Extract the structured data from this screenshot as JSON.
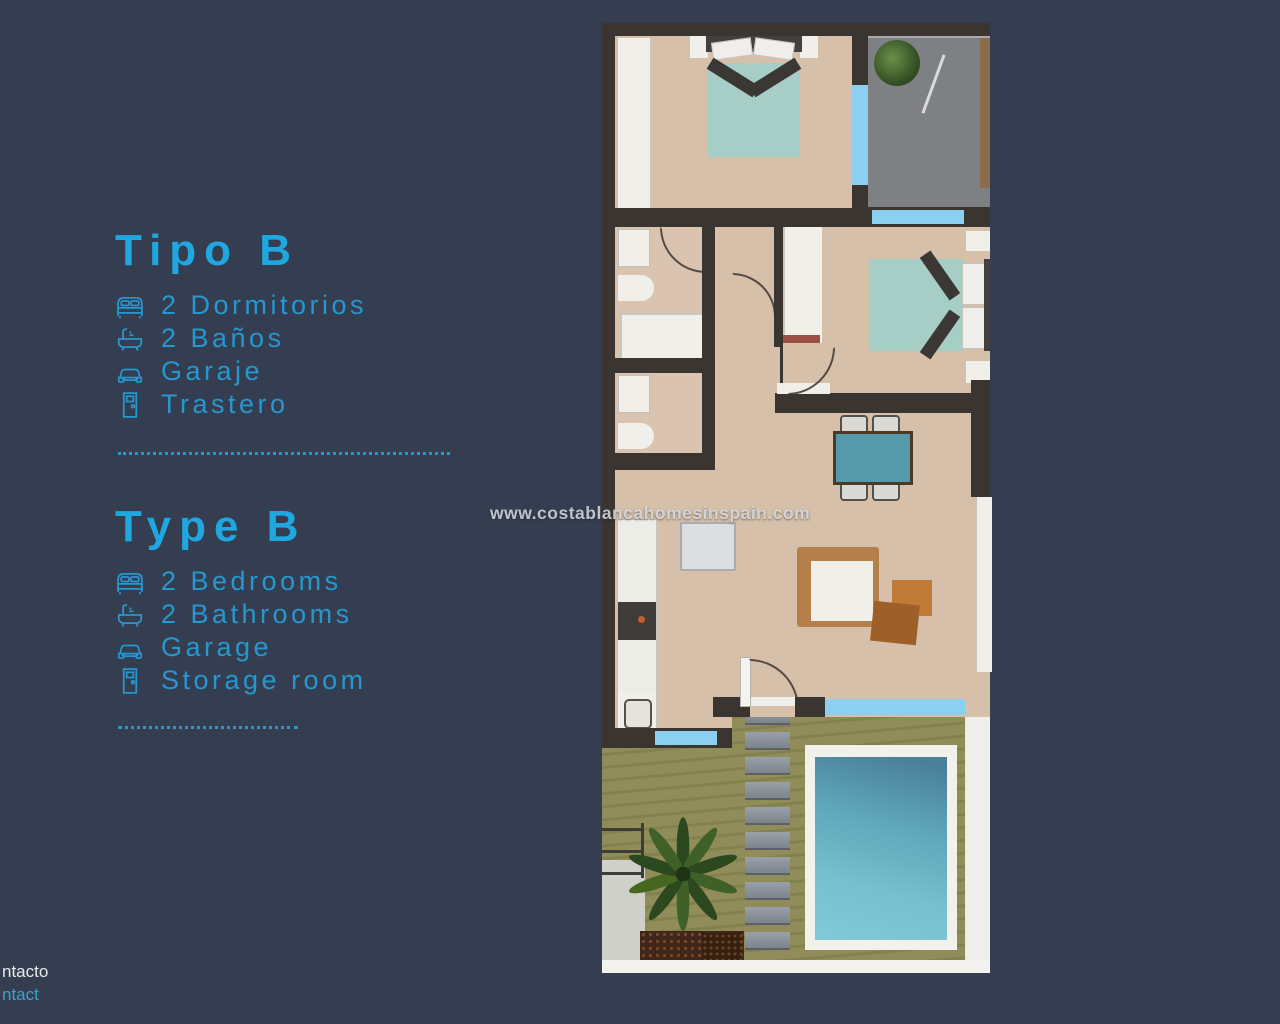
{
  "page": {
    "background_color": "#353e50",
    "accent_color": "#1ea7e0"
  },
  "panel_spanish": {
    "title": "Tipo B",
    "items": [
      {
        "icon": "bed-icon",
        "label": "2 Dormitorios"
      },
      {
        "icon": "bath-icon",
        "label": "2 Baños"
      },
      {
        "icon": "car-icon",
        "label": "Garaje"
      },
      {
        "icon": "door-icon",
        "label": "Trastero"
      }
    ]
  },
  "panel_english": {
    "title": "Type B",
    "items": [
      {
        "icon": "bed-icon",
        "label": "2 Bedrooms"
      },
      {
        "icon": "bath-icon",
        "label": "2 Bathrooms"
      },
      {
        "icon": "car-icon",
        "label": "Garage"
      },
      {
        "icon": "door-icon",
        "label": "Storage room"
      }
    ]
  },
  "watermark": {
    "text": "www.costablancahomesinspain.com"
  },
  "footer": {
    "contact_spanish_partial": "ntacto",
    "contact_english_partial": "ntact"
  },
  "floorplan": {
    "description": "top-down 2-bedroom apartment plan with terrace garden and pool",
    "colors": {
      "wall": "#3a3531",
      "floor_tan": "#d7c0a9",
      "window_blue": "#8cd0f1",
      "bed_teal": "#a6cdc6",
      "dining_teal": "#5599ab",
      "driveway_gray": "#7e8083",
      "garden_olive": "#8f8c59",
      "pool_water": "#5da4b7",
      "pool_deck_white": "#f2f1ec"
    }
  }
}
